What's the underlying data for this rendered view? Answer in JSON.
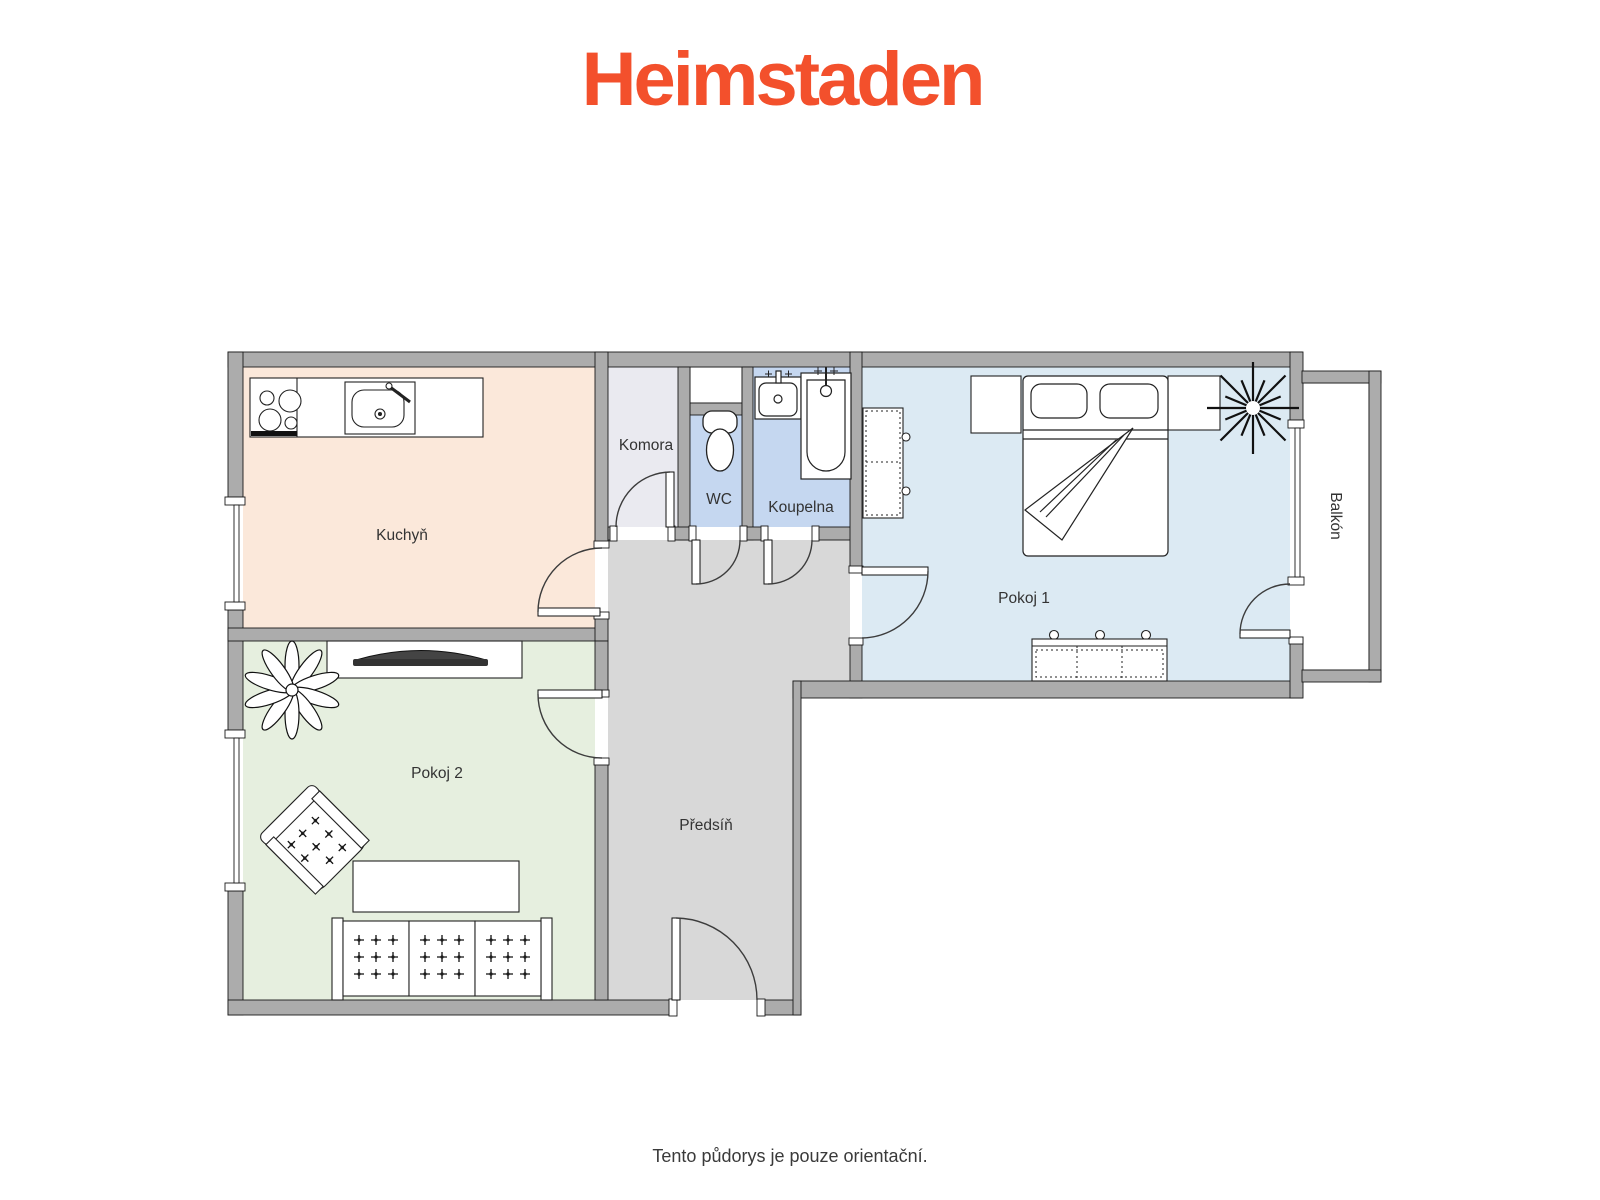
{
  "brand": {
    "logo_text": "Heimstaden",
    "logo_color": "#F3502C"
  },
  "caption": "Tento půdorys je pouze orientační.",
  "plan": {
    "wall_color": "#ACACAC",
    "rooms": {
      "kuchyn": {
        "label": "Kuchyň",
        "fill": "#FBE8DA"
      },
      "komora": {
        "label": "Komora",
        "fill": "#EAEAF0"
      },
      "wc": {
        "label": "WC",
        "fill": "#C5D7F0"
      },
      "koupelna": {
        "label": "Koupelna",
        "fill": "#C5D7F0"
      },
      "pokoj1": {
        "label": "Pokoj 1",
        "fill": "#DCEAF3"
      },
      "pokoj2": {
        "label": "Pokoj 2",
        "fill": "#E6EFDF"
      },
      "predsin": {
        "label": "Předsíň",
        "fill": "#D8D8D8"
      },
      "balkon": {
        "label": "Balkón",
        "fill": "#FFFFFF"
      }
    },
    "symbols": [
      "stove",
      "kitchen-sink",
      "toilet",
      "washbasin",
      "bathtub",
      "double-bed",
      "nightstand",
      "wardrobe",
      "dresser",
      "plant",
      "tv",
      "armchair",
      "coffee-table",
      "sofa",
      "door",
      "window"
    ]
  }
}
